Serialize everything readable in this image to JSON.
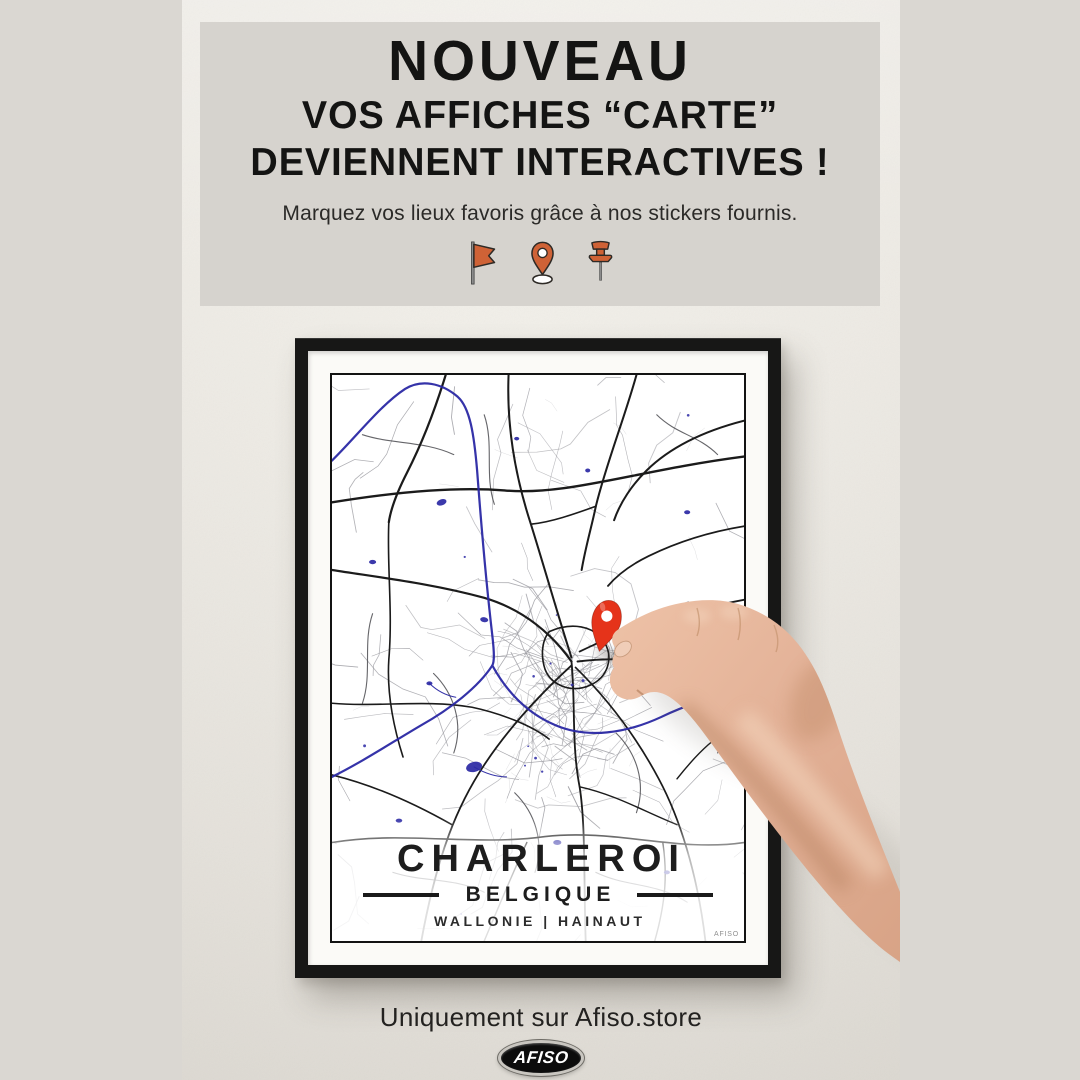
{
  "banner": {
    "title": "NOUVEAU",
    "line1": "VOS AFFICHES “CARTE”",
    "line2": "DEVIENNENT INTERACTIVES !",
    "tagline": "Marquez vos lieux favoris grâce à nos stickers fournis.",
    "icons": [
      "flag-icon",
      "map-pin-icon",
      "push-pin-icon"
    ],
    "accent_color": "#cf6236"
  },
  "poster": {
    "title": "CHARLEROI",
    "subtitle": "BELGIQUE",
    "region_line": "WALLONIE | HAINAUT",
    "corner_mark": "AFISO",
    "map": {
      "background": "#ffffff",
      "road_major_color": "#1b1b1b",
      "road_medium_color": "#4b4b50",
      "road_minor_color": "#9b9ba1",
      "water_color": "#2a28a4",
      "pin_color": "#e5331a"
    }
  },
  "footer": {
    "availability": "Uniquement sur Afiso.store",
    "brand": "AFISO"
  }
}
